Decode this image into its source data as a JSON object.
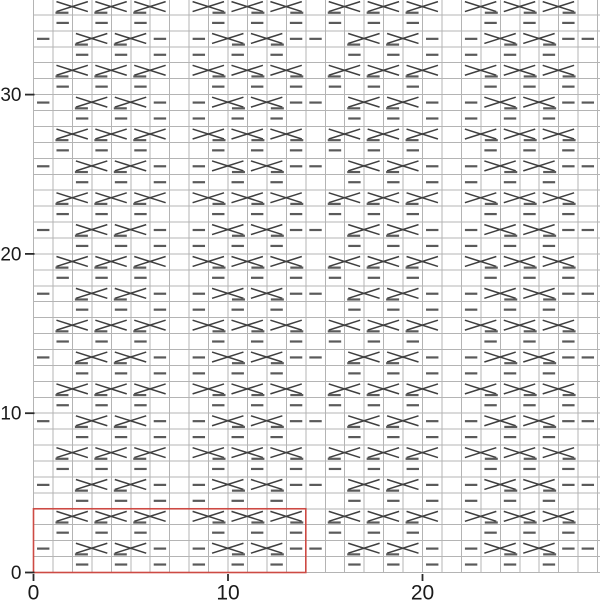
{
  "chart_data": {
    "type": "knitting-symbol-chart",
    "grid": {
      "cols": 30,
      "rows": 36,
      "cell_w": 19.45,
      "cell_h": 15.93,
      "origin_x": 33.5,
      "origin_y": 572.5
    },
    "axes": {
      "x": {
        "ticks": [
          {
            "label": "0",
            "value": 0
          },
          {
            "label": "10",
            "value": 10
          },
          {
            "label": "20",
            "value": 20
          }
        ]
      },
      "y": {
        "ticks": [
          {
            "label": "0",
            "value": 0
          },
          {
            "label": "10",
            "value": 10
          },
          {
            "label": "20",
            "value": 20
          },
          {
            "label": "30",
            "value": 30
          }
        ]
      }
    },
    "pattern": {
      "width": 14,
      "height": 4,
      "row_order": "bottom-to-top",
      "rows": [
        {
          "purl": [
            2,
            4,
            6,
            8,
            10,
            12
          ],
          "cross_left": [],
          "cross_right": []
        },
        {
          "purl": [
            0,
            6,
            8,
            13
          ],
          "cross_left": [
            2,
            4
          ],
          "cross_right": [
            9,
            11
          ]
        },
        {
          "purl": [
            1,
            3,
            5,
            9,
            11,
            13
          ],
          "cross_left": [],
          "cross_right": []
        },
        {
          "purl": [],
          "cross_left": [
            1,
            3,
            5
          ],
          "cross_right": [
            8,
            10,
            12
          ]
        }
      ]
    },
    "repeat_box": {
      "col": 0,
      "row": 0,
      "width": 14,
      "height": 4
    },
    "colors": {
      "background": "#ffffff",
      "grid": "#b4b4b4",
      "cross": "#3f3f3f",
      "purl": "#5a5a5a",
      "repeat_box": "#cd4a44",
      "tick": "#2a2a2a",
      "axis_text": "#1a1a1a"
    },
    "font": {
      "y_label_size": 19,
      "x_label_size": 21
    }
  }
}
